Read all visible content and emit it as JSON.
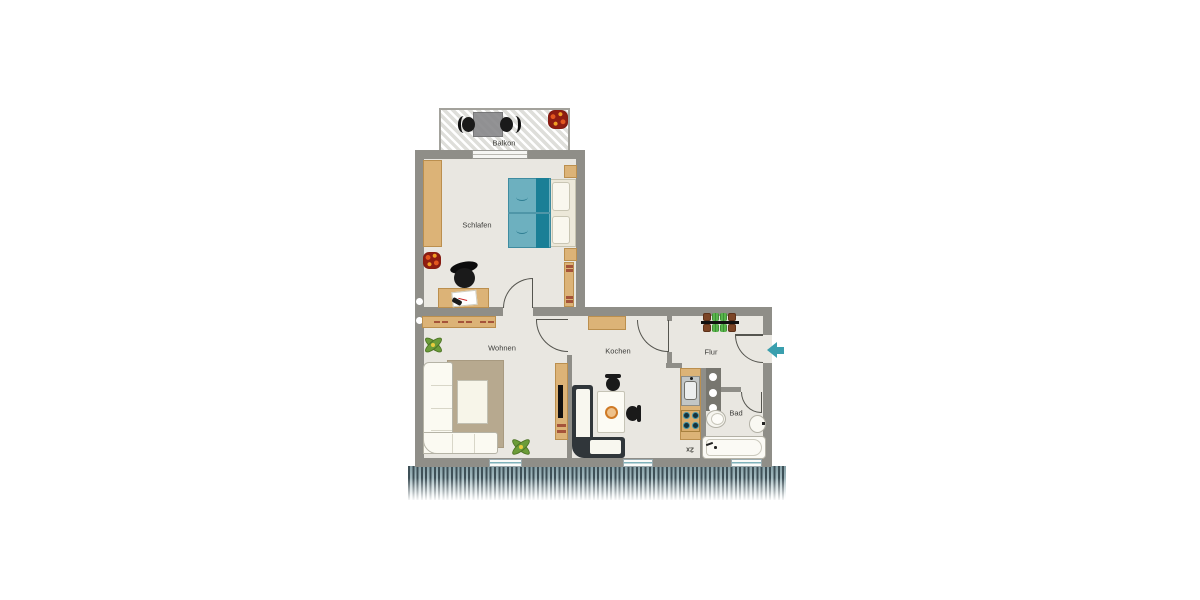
{
  "floorplan": {
    "rooms": [
      {
        "id": "balkon",
        "label": "Balkon"
      },
      {
        "id": "schlafen",
        "label": "Schlafen"
      },
      {
        "id": "wohnen",
        "label": "Wohnen"
      },
      {
        "id": "kochen",
        "label": "Kochen"
      },
      {
        "id": "flur",
        "label": "Flur"
      },
      {
        "id": "bad",
        "label": "Bad"
      }
    ],
    "annotations": [
      {
        "id": "stove-count",
        "label": "2x"
      }
    ],
    "icons": [
      {
        "name": "entrance-arrow-icon",
        "meaning": "apartment entrance direction"
      }
    ],
    "colors": {
      "wall": "#8f8e88",
      "floor": "#e9e7e1",
      "wood": "#dcb377",
      "bed_teal": "#6db0bf",
      "bed_stripe": "#1a7f96",
      "accent_teal": "#3a9fae",
      "fringe": "#4a5b61",
      "plant_green": "#6b9c39",
      "flower_red": "#a62c1a",
      "chair_black": "#1a1a1a"
    }
  }
}
